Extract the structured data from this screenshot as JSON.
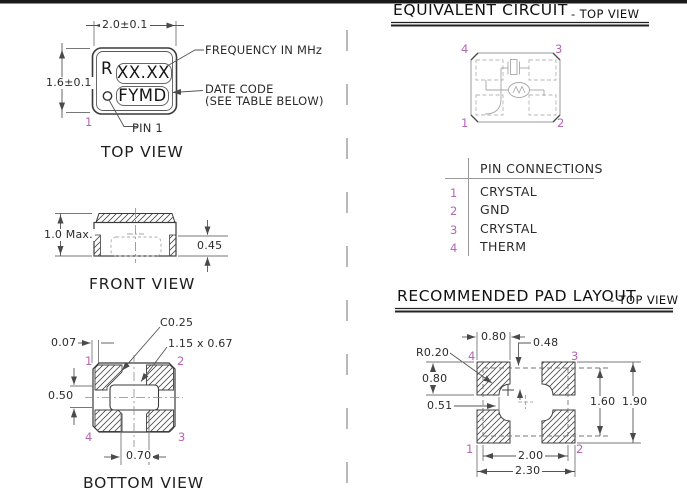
{
  "colors": {
    "pin_number": "#b565b5",
    "line": "#3a3a3a",
    "dim_line": "#666666",
    "hatch": "#4a4a4a"
  },
  "top_view": {
    "title": "TOP VIEW",
    "dim_width": "2.0±0.1",
    "dim_height": "1.6±0.1",
    "marking_prefix": "R",
    "marking_frequency": "XX.XX",
    "marking_datecode": "FYMD",
    "callout_frequency": "FREQUENCY IN MHz",
    "callout_datecode_line1": "DATE CODE",
    "callout_datecode_line2": "(SEE TABLE BELOW)",
    "callout_pin1": "PIN 1",
    "pin1": "1"
  },
  "front_view": {
    "title": "FRONT VIEW",
    "dim_height": "1.0 Max.",
    "dim_pad_height": "0.45"
  },
  "bottom_view": {
    "title": "BOTTOM VIEW",
    "dim_chamfer": "C0.25",
    "dim_cavity": "1.15 x 0.67",
    "dim_edge_offset": "0.07",
    "dim_pad_height": "0.50",
    "dim_pad_gap": "0.70",
    "pins": {
      "p1": "1",
      "p2": "2",
      "p3": "3",
      "p4": "4"
    }
  },
  "equivalent_circuit": {
    "title": "EQUIVALENT CIRCUIT",
    "subtitle": "- TOP VIEW",
    "pins": {
      "p1": "1",
      "p2": "2",
      "p3": "3",
      "p4": "4"
    }
  },
  "pin_connections": {
    "header": "PIN CONNECTIONS",
    "rows": [
      {
        "pin": "1",
        "connection": "CRYSTAL"
      },
      {
        "pin": "2",
        "connection": "GND"
      },
      {
        "pin": "3",
        "connection": "CRYSTAL"
      },
      {
        "pin": "4",
        "connection": "THERM"
      }
    ]
  },
  "pad_layout": {
    "title": "RECOMMENDED PAD LAYOUT",
    "subtitle": "- TOP VIEW",
    "dims": {
      "pad_width": "0.80",
      "top_offset": "0.48",
      "corner_radius": "R0.20",
      "pad_height": "0.80",
      "side_offset": "0.51",
      "inner_height": "1.60",
      "outer_height": "1.90",
      "inner_width": "2.00",
      "outer_width": "2.30"
    },
    "pins": {
      "p1": "1",
      "p2": "2",
      "p3": "3",
      "p4": "4"
    }
  }
}
